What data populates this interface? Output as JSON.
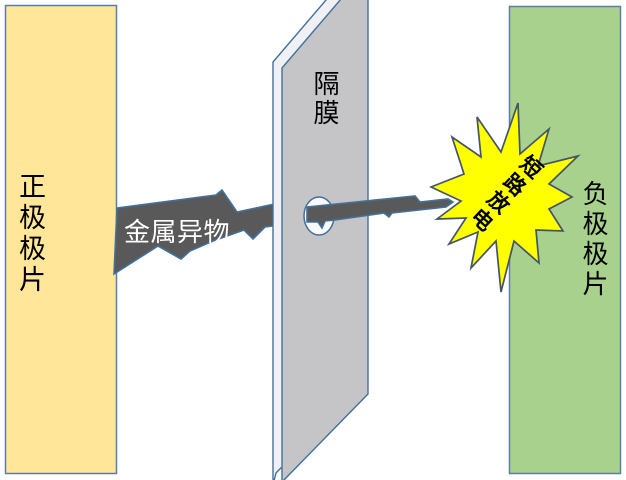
{
  "diagram": {
    "background": "#FFFFFF",
    "positive_electrode": {
      "label": "正极极片",
      "fill": "#FFE699"
    },
    "separator": {
      "label": "隔膜",
      "fill": "#C5C5C7",
      "side_fill": "#F1F1F5",
      "hole_fill": "#FAFAFC"
    },
    "negative_electrode": {
      "label": "负极极片",
      "fill": "#A9D18E"
    },
    "metal_object": {
      "label": "金属异物",
      "fill": "#595959",
      "label_color": "#FFFFFF"
    },
    "short_circuit_burst": {
      "label": "短路放电",
      "fill": "#FFFF00",
      "label_color": "#000000"
    },
    "outline_color": "#41719C",
    "burst_outline_color": "#44546A"
  }
}
